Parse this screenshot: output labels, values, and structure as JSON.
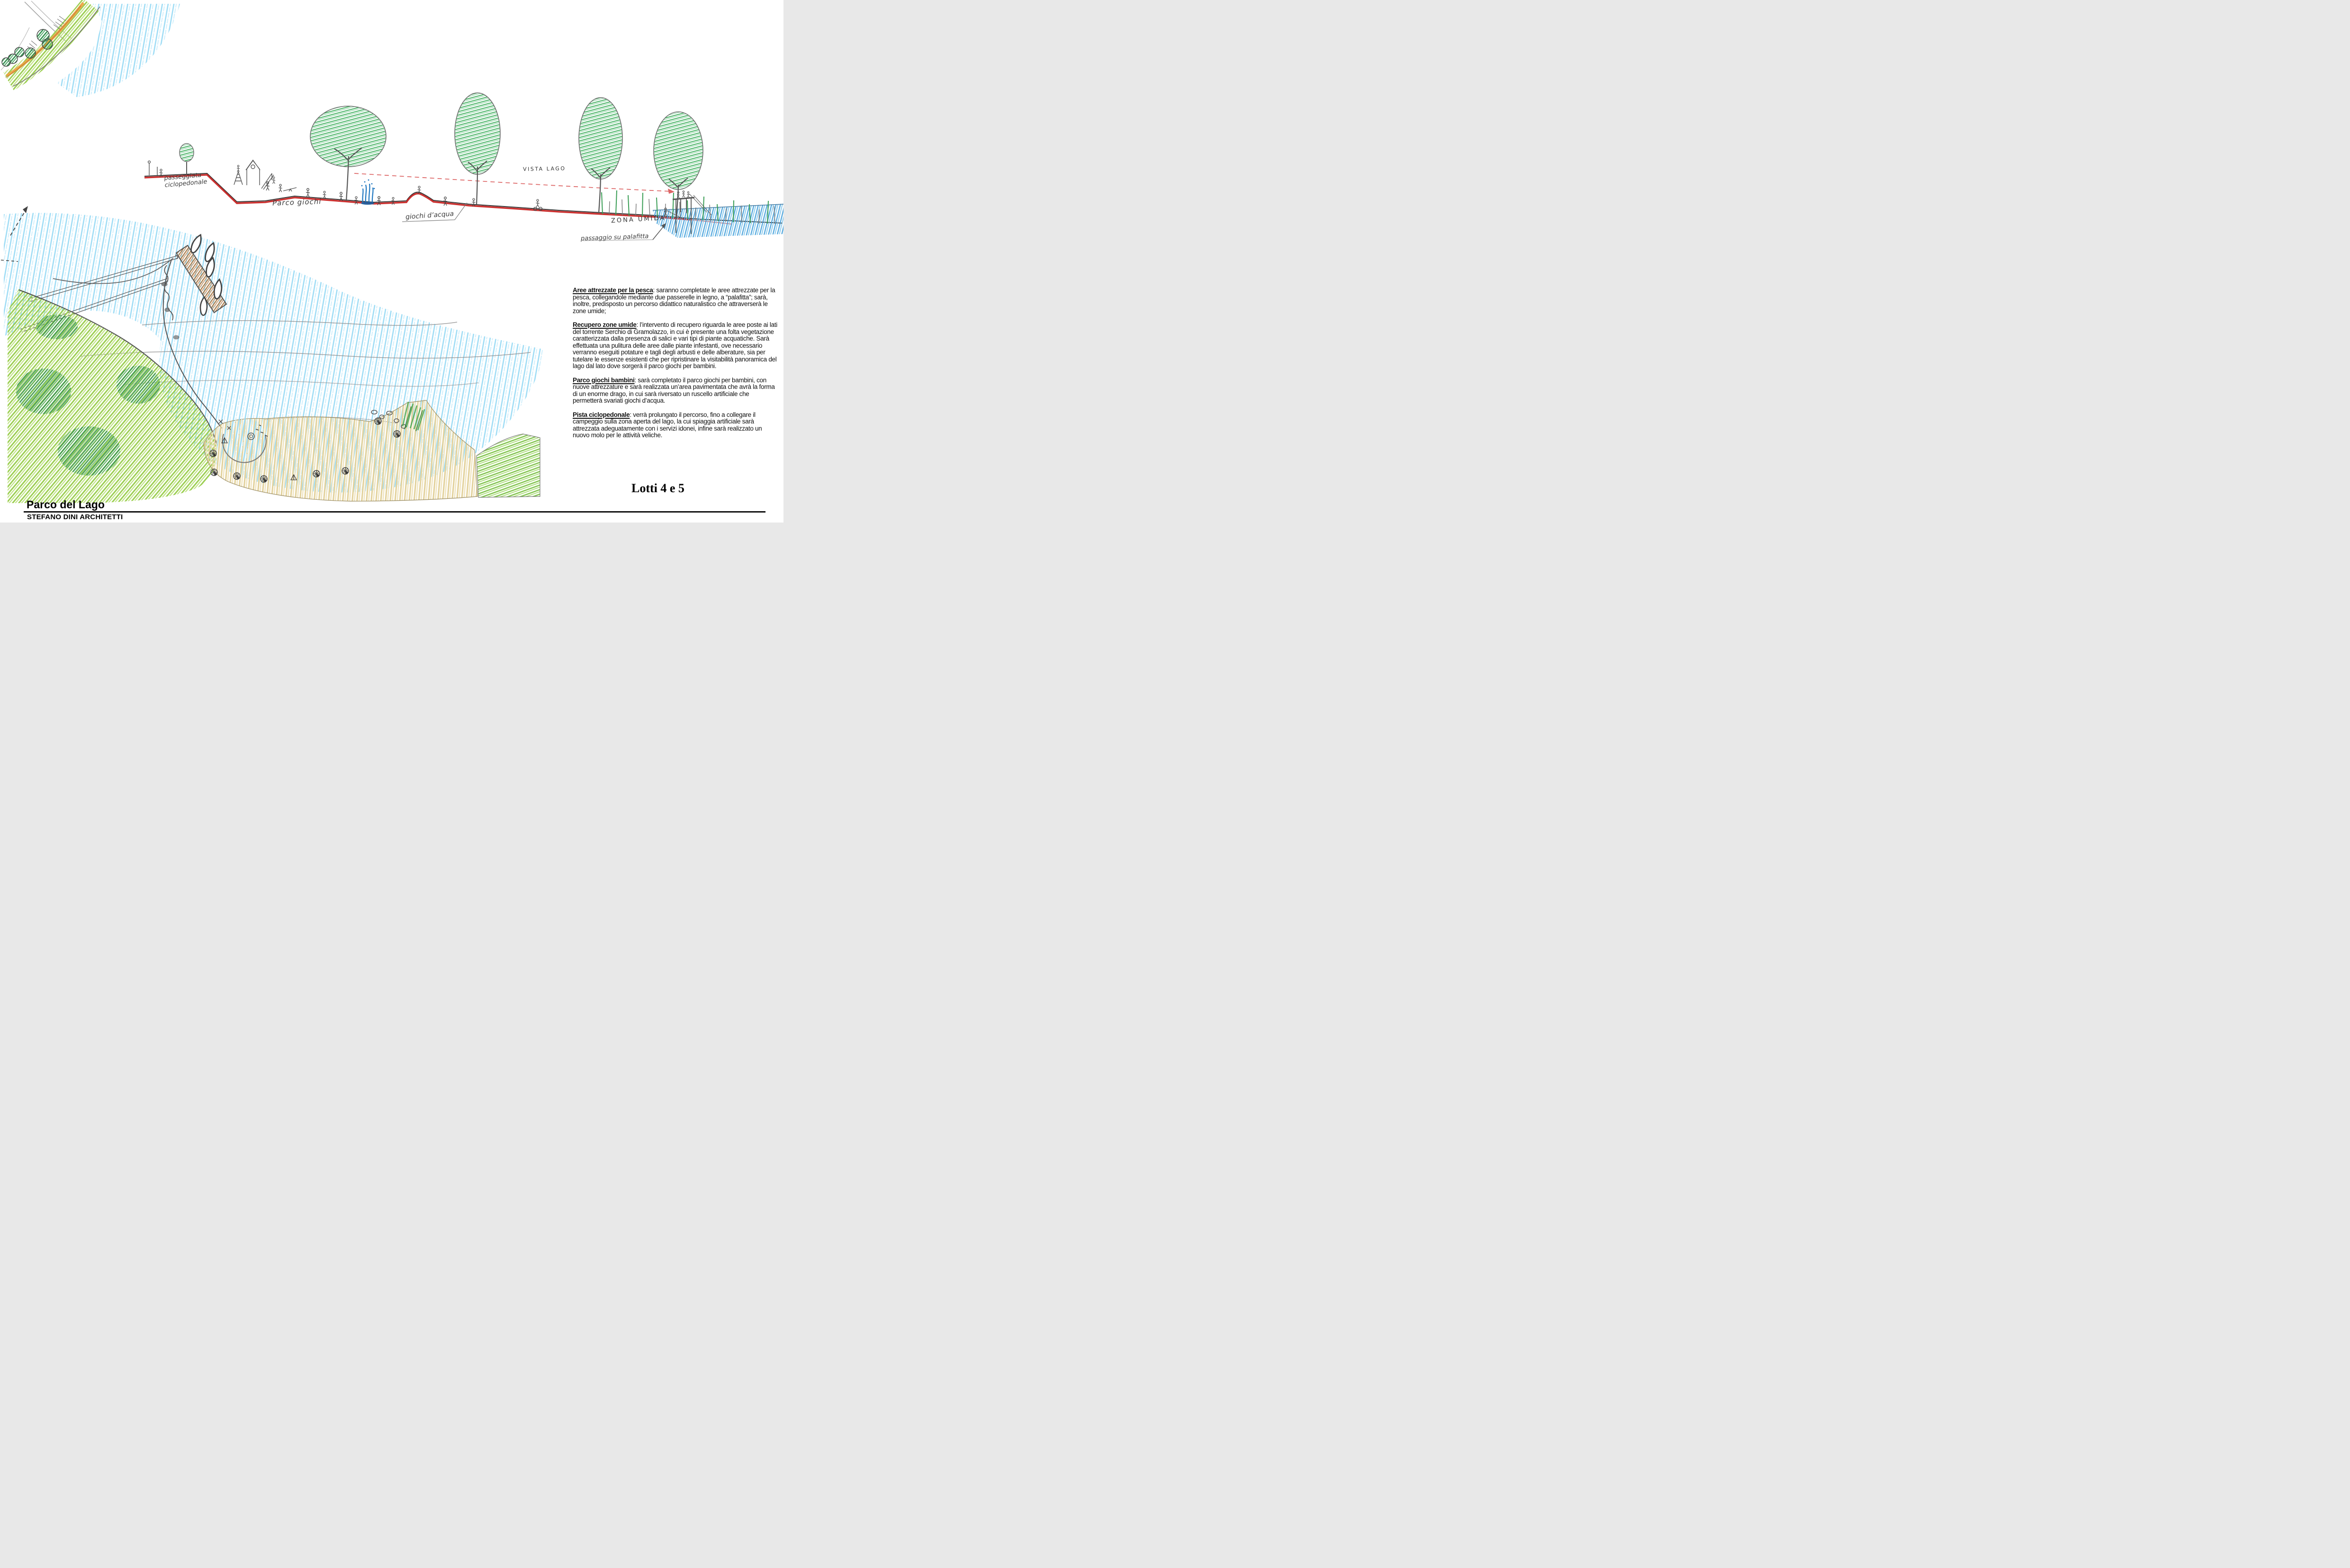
{
  "notes": [
    {
      "heading": "Aree attrezzate per la pesca",
      "body": ": saranno completate le aree attrezzate per la pesca, collegandole mediante due passerelle in legno, a “palafitta”; sarà, inoltre, predisposto un percorso didattico naturalistico che attraverserà le zone umide;"
    },
    {
      "heading": "Recupero zone umide",
      "body": ": l’intervento di recupero riguarda le aree poste ai lati del torrente Serchio di Gramolazzo, in cui è presente una folta vegetazione caratterizzata dalla presenza di salici e vari tipi di piante acquatiche. Sarà effettuata una pulitura delle aree dalle piante infestanti, ove necessario verranno eseguiti potature e tagli degli arbusti e delle alberature, sia per tutelare  le essenze esistenti che per ripristinare la visitabilità panoramica  del lago dal lato dove sorgerà il parco giochi per  bambini."
    },
    {
      "heading": "Parco  giochi bambini",
      "body": ": sarà completato il parco giochi per bambini, con nuove attrezzature e sarà realizzata un’area pavimentata che avrà la forma di un enorme drago, in cui sarà riversato un ruscello artificiale che permetterà svariati giochi d’acqua."
    },
    {
      "heading": "Pista ciclopedonale",
      "body": ": verrà prolungato il percorso, fino a collegare il campeggio sulla zona aperta del lago, la cui spiaggia artificiale  sarà attrezzata adeguatamente con i servizi idonei, infine sarà realizzato un nuovo molo per le attività veliche."
    }
  ],
  "sketch_labels": {
    "cycle_path": "passeggiata ciclopedonale",
    "playground": "Parco giochi",
    "water_games": "giochi d’acqua",
    "lake_view": "VISTA LAGO",
    "wetland": "ZONA UMIDA",
    "stilt_walk": "passaggio su palafitta"
  },
  "footer": {
    "project_title": "Parco del Lago",
    "studio": "STEFANO DINI ARCHITETTI"
  },
  "lot_label": "Lotti 4 e 5",
  "palette": {
    "path_red": "#c8201e",
    "water_blue_light": "#9ddcf5",
    "water_blue_mid": "#4aa3dc",
    "fountain_blue": "#1f77c0",
    "tree_green": "#3faf5d",
    "lawn_green": "#9ccf52",
    "dark_green": "#2f8f4d",
    "sand_tan": "#e3d29c",
    "route_orange": "#eda23f",
    "pier_brown": "#b07a45",
    "pencil_gray": "#555555"
  }
}
